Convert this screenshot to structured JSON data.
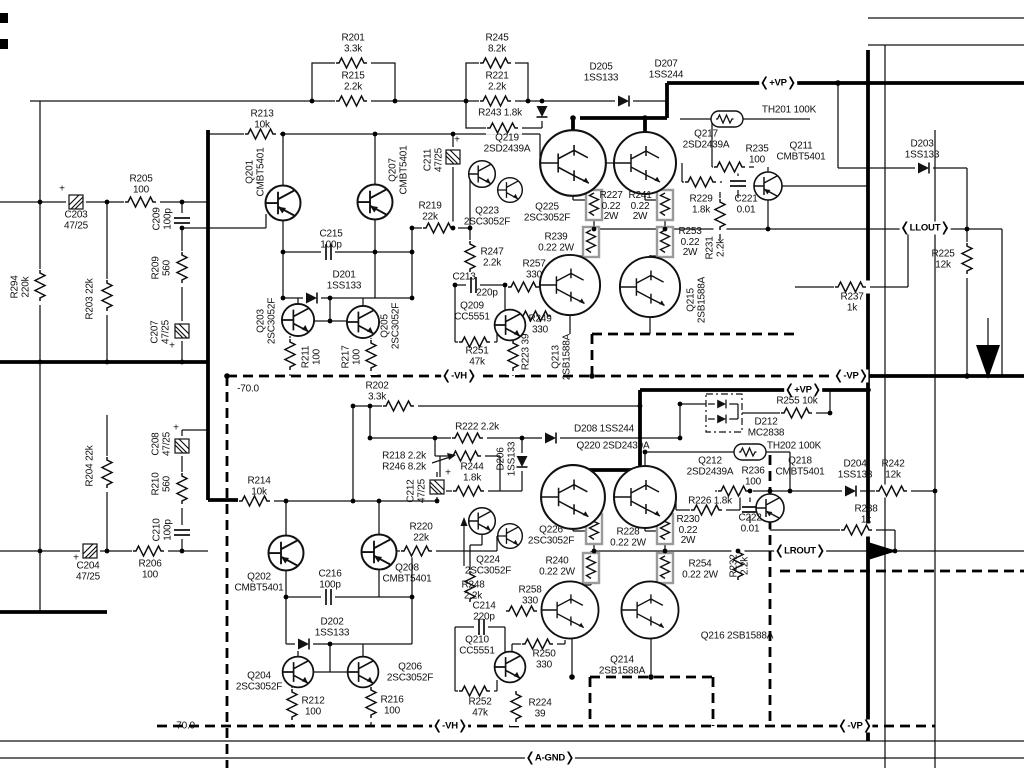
{
  "meta": {
    "description": "Stereo power amplifier output stage schematic, left (LLOUT) and right (LROUT) channels",
    "colors": {
      "ink": "#111111",
      "background": "#ffffff",
      "box_outline": "#9a9a9a"
    }
  },
  "power_badges": [
    {
      "id": "vp-top",
      "text": "+VP",
      "x": 778,
      "y": 83
    },
    {
      "id": "llout",
      "text": "LLOUT",
      "x": 925,
      "y": 228
    },
    {
      "id": "vh-upper",
      "text": "-VH",
      "x": 459,
      "y": 376
    },
    {
      "id": "vp-upper-minus",
      "text": "-VP",
      "x": 851,
      "y": 376
    },
    {
      "id": "vp-lower-plus",
      "text": "+VP",
      "x": 803,
      "y": 390
    },
    {
      "id": "lrout",
      "text": "LROUT",
      "x": 800,
      "y": 551
    },
    {
      "id": "vh-lower",
      "text": "-VH",
      "x": 450,
      "y": 726
    },
    {
      "id": "vp-bottom",
      "text": "-VP",
      "x": 855,
      "y": 726
    },
    {
      "id": "a-gnd",
      "text": "A-GND",
      "x": 550,
      "y": 758
    }
  ],
  "component_labels": [
    {
      "id": "r201",
      "text": "R201\n3.3k",
      "x": 353,
      "y": 44
    },
    {
      "id": "r215",
      "text": "R215\n2.2k",
      "x": 353,
      "y": 82
    },
    {
      "id": "r245",
      "text": "R245\n8.2k",
      "x": 497,
      "y": 44
    },
    {
      "id": "r221",
      "text": "R221\n2.2k",
      "x": 497,
      "y": 82
    },
    {
      "id": "r243",
      "text": "R243 1.8k",
      "x": 500,
      "y": 114
    },
    {
      "id": "d205",
      "text": "D205\n1SS133",
      "x": 601,
      "y": 73
    },
    {
      "id": "d207",
      "text": "D207\n1SS244",
      "x": 666,
      "y": 70
    },
    {
      "id": "th201",
      "text": "TH201 100K",
      "x": 789,
      "y": 111
    },
    {
      "id": "q217",
      "text": "Q217\n2SD2439A",
      "x": 706,
      "y": 140
    },
    {
      "id": "r235",
      "text": "R235\n100",
      "x": 757,
      "y": 155
    },
    {
      "id": "q211",
      "text": "Q211\nCMBT5401",
      "x": 801,
      "y": 152
    },
    {
      "id": "d203",
      "text": "D203\n1SS133",
      "x": 922,
      "y": 150
    },
    {
      "id": "r213",
      "text": "R213\n10k",
      "x": 262,
      "y": 120
    },
    {
      "id": "q201",
      "text": "Q201\nCMBT5401",
      "x": 256,
      "y": 172,
      "rot": -90
    },
    {
      "id": "q207",
      "text": "Q207\nCMBT5401",
      "x": 399,
      "y": 170,
      "rot": -90
    },
    {
      "id": "c211",
      "text": "C211\n47/25",
      "x": 434,
      "y": 160,
      "rot": -90
    },
    {
      "id": "plus-c211",
      "text": "+",
      "x": 457,
      "y": 141
    },
    {
      "id": "r219",
      "text": "R219\n22k",
      "x": 430,
      "y": 212
    },
    {
      "id": "c203",
      "text": "C203\n47/25",
      "x": 76,
      "y": 221
    },
    {
      "id": "plus-c203",
      "text": "+",
      "x": 62,
      "y": 190
    },
    {
      "id": "r205",
      "text": "R205\n100",
      "x": 141,
      "y": 185
    },
    {
      "id": "c209",
      "text": "C209\n100p",
      "x": 163,
      "y": 219,
      "rot": -90
    },
    {
      "id": "r209",
      "text": "R209\n560",
      "x": 162,
      "y": 268,
      "rot": -90
    },
    {
      "id": "r294",
      "text": "R294\n220k",
      "x": 21,
      "y": 287,
      "rot": -90
    },
    {
      "id": "r203",
      "text": "R203 22k",
      "x": 91,
      "y": 299,
      "rot": -90
    },
    {
      "id": "c207",
      "text": "C207\n47/25",
      "x": 161,
      "y": 332,
      "rot": -90
    },
    {
      "id": "plus-c207",
      "text": "+",
      "x": 172,
      "y": 347
    },
    {
      "id": "c215",
      "text": "C215\n100p",
      "x": 331,
      "y": 240
    },
    {
      "id": "d201",
      "text": "D201\n1SS133",
      "x": 344,
      "y": 281
    },
    {
      "id": "q203",
      "text": "Q203\n2SC3052F",
      "x": 267,
      "y": 321,
      "rot": -90
    },
    {
      "id": "q205",
      "text": "Q205\n2SC3052F",
      "x": 391,
      "y": 326,
      "rot": -90
    },
    {
      "id": "r211",
      "text": "R211\n100",
      "x": 312,
      "y": 357,
      "rot": -90
    },
    {
      "id": "r217",
      "text": "R217\n100",
      "x": 352,
      "y": 357,
      "rot": -90
    },
    {
      "id": "q219",
      "text": "Q219\n2SD2439A",
      "x": 507,
      "y": 144
    },
    {
      "id": "q223",
      "text": "Q223\n2SC3052F",
      "x": 487,
      "y": 217
    },
    {
      "id": "q225",
      "text": "Q225\n2SC3052F",
      "x": 547,
      "y": 213
    },
    {
      "id": "r247",
      "text": "R247\n2.2k",
      "x": 492,
      "y": 258
    },
    {
      "id": "c213",
      "text": "C213",
      "x": 464,
      "y": 278
    },
    {
      "id": "c213-value",
      "text": "220p",
      "x": 487,
      "y": 294
    },
    {
      "id": "q209",
      "text": "Q209\nCC5551",
      "x": 472,
      "y": 312
    },
    {
      "id": "r257",
      "text": "R257\n330",
      "x": 534,
      "y": 270
    },
    {
      "id": "r249",
      "text": "R249\n330",
      "x": 540,
      "y": 325
    },
    {
      "id": "r251",
      "text": "R251\n47k",
      "x": 477,
      "y": 357
    },
    {
      "id": "r223",
      "text": "R223 39",
      "x": 527,
      "y": 352,
      "rot": -90
    },
    {
      "id": "r227",
      "text": "R227\n0.22\n2W",
      "x": 611,
      "y": 207
    },
    {
      "id": "r241",
      "text": "R241\n0.22\n2W",
      "x": 640,
      "y": 207
    },
    {
      "id": "r239",
      "text": "R239\n0.22 2W",
      "x": 556,
      "y": 243
    },
    {
      "id": "r253",
      "text": "R253\n0.22\n2W",
      "x": 690,
      "y": 243
    },
    {
      "id": "r229",
      "text": "R229\n1.8k",
      "x": 701,
      "y": 205
    },
    {
      "id": "c221",
      "text": "C221\n0.01",
      "x": 746,
      "y": 205
    },
    {
      "id": "r231",
      "text": "R231\n2.2k",
      "x": 716,
      "y": 248,
      "rot": -90
    },
    {
      "id": "q213",
      "text": "Q213\n2SB1588A",
      "x": 562,
      "y": 357,
      "rot": -90
    },
    {
      "id": "q215",
      "text": "Q215\n2SB1588A",
      "x": 697,
      "y": 300,
      "rot": -90
    },
    {
      "id": "r225",
      "text": "R225\n12k",
      "x": 943,
      "y": 260
    },
    {
      "id": "r237",
      "text": "R237\n1k",
      "x": 852,
      "y": 303
    },
    {
      "id": "note-70-top",
      "text": "-70.0",
      "x": 248,
      "y": 390
    },
    {
      "id": "r202",
      "text": "R202\n3.3k",
      "x": 377,
      "y": 392
    },
    {
      "id": "r222",
      "text": "R222 2.2k",
      "x": 477,
      "y": 428
    },
    {
      "id": "r218-r246",
      "text": "R218 2.2k\nR246 8.2k",
      "x": 404,
      "y": 462
    },
    {
      "id": "r244",
      "text": "R244\n1.8k",
      "x": 472,
      "y": 473
    },
    {
      "id": "d206",
      "text": "D206\n1SS133",
      "x": 507,
      "y": 459,
      "rot": -90
    },
    {
      "id": "c212",
      "text": "C212\n47/25",
      "x": 417,
      "y": 491,
      "rot": -90
    },
    {
      "id": "plus-c212",
      "text": "+",
      "x": 448,
      "y": 474
    },
    {
      "id": "d208",
      "text": "D208 1SS244",
      "x": 604,
      "y": 430
    },
    {
      "id": "q220",
      "text": "Q220 2SD2439A",
      "x": 613,
      "y": 447
    },
    {
      "id": "d212",
      "text": "D212\nMC2838",
      "x": 766,
      "y": 428
    },
    {
      "id": "r255",
      "text": "R255 10k",
      "x": 797,
      "y": 402
    },
    {
      "id": "th202",
      "text": "TH202 100K",
      "x": 794,
      "y": 447
    },
    {
      "id": "q212",
      "text": "Q212\n2SD2439A",
      "x": 710,
      "y": 467
    },
    {
      "id": "r236",
      "text": "R236\n100",
      "x": 753,
      "y": 477
    },
    {
      "id": "q218",
      "text": "Q218\nCMBT5401",
      "x": 800,
      "y": 467
    },
    {
      "id": "d204",
      "text": "D204\n1SS133",
      "x": 855,
      "y": 470
    },
    {
      "id": "r242",
      "text": "R242\n12k",
      "x": 893,
      "y": 470
    },
    {
      "id": "r226",
      "text": "R226 1.8k",
      "x": 710,
      "y": 502
    },
    {
      "id": "r230",
      "text": "R230\n0.22\n2W",
      "x": 688,
      "y": 531
    },
    {
      "id": "c222",
      "text": "C222\n0.01",
      "x": 750,
      "y": 524
    },
    {
      "id": "r232",
      "text": "R232\n2.2k",
      "x": 740,
      "y": 566,
      "rot": -90
    },
    {
      "id": "r254",
      "text": "R254\n0.22 2W",
      "x": 700,
      "y": 570
    },
    {
      "id": "r238",
      "text": "R238\n1k",
      "x": 866,
      "y": 515
    },
    {
      "id": "r214",
      "text": "R214\n10k",
      "x": 259,
      "y": 487
    },
    {
      "id": "r204",
      "text": "R204 22k",
      "x": 91,
      "y": 466,
      "rot": -90
    },
    {
      "id": "c208",
      "text": "C208\n47/25",
      "x": 162,
      "y": 444,
      "rot": -90
    },
    {
      "id": "plus-c208",
      "text": "+",
      "x": 176,
      "y": 429
    },
    {
      "id": "r210",
      "text": "R210\n560",
      "x": 162,
      "y": 484,
      "rot": -90
    },
    {
      "id": "c210",
      "text": "C210\n100p",
      "x": 163,
      "y": 530,
      "rot": -90
    },
    {
      "id": "c204",
      "text": "C204\n47/25",
      "x": 88,
      "y": 572
    },
    {
      "id": "plus-c204",
      "text": "+",
      "x": 76,
      "y": 559
    },
    {
      "id": "r206",
      "text": "R206\n100",
      "x": 150,
      "y": 570
    },
    {
      "id": "q202",
      "text": "Q202\nCMBT5401",
      "x": 259,
      "y": 583
    },
    {
      "id": "c216",
      "text": "C216\n100p",
      "x": 330,
      "y": 580
    },
    {
      "id": "q208",
      "text": "Q208\nCMBT5401",
      "x": 407,
      "y": 574
    },
    {
      "id": "r220",
      "text": "R220\n22k",
      "x": 421,
      "y": 533
    },
    {
      "id": "q226",
      "text": "Q226\n2SC3052F",
      "x": 551,
      "y": 536
    },
    {
      "id": "q224",
      "text": "Q224\n2SC3052F",
      "x": 488,
      "y": 566
    },
    {
      "id": "r248",
      "text": "R248\n2.2k",
      "x": 473,
      "y": 591
    },
    {
      "id": "c214",
      "text": "C214\n220p",
      "x": 484,
      "y": 612
    },
    {
      "id": "r240",
      "text": "R240\n0.22 2W",
      "x": 557,
      "y": 567
    },
    {
      "id": "r228",
      "text": "R228\n0.22 2W",
      "x": 628,
      "y": 538
    },
    {
      "id": "r258",
      "text": "R258\n330",
      "x": 530,
      "y": 596
    },
    {
      "id": "q210",
      "text": "Q210\nCC5551",
      "x": 477,
      "y": 646
    },
    {
      "id": "r250",
      "text": "R250\n330",
      "x": 544,
      "y": 660
    },
    {
      "id": "d202",
      "text": "D202\n1SS133",
      "x": 332,
      "y": 628
    },
    {
      "id": "q204",
      "text": "Q204\n2SC3052F",
      "x": 259,
      "y": 682
    },
    {
      "id": "q206",
      "text": "Q206\n2SC3052F",
      "x": 410,
      "y": 673
    },
    {
      "id": "r212",
      "text": "R212\n100",
      "x": 313,
      "y": 707
    },
    {
      "id": "r216",
      "text": "R216\n100",
      "x": 392,
      "y": 706
    },
    {
      "id": "r252",
      "text": "R252\n47k",
      "x": 480,
      "y": 708
    },
    {
      "id": "r224",
      "text": "R224\n39",
      "x": 540,
      "y": 709
    },
    {
      "id": "q214",
      "text": "Q214\n2SB1588A",
      "x": 622,
      "y": 666
    },
    {
      "id": "q216",
      "text": "Q216 2SB1588A",
      "x": 737,
      "y": 637
    },
    {
      "id": "note-70-bottom",
      "text": "-70.0",
      "x": 184,
      "y": 727
    }
  ]
}
